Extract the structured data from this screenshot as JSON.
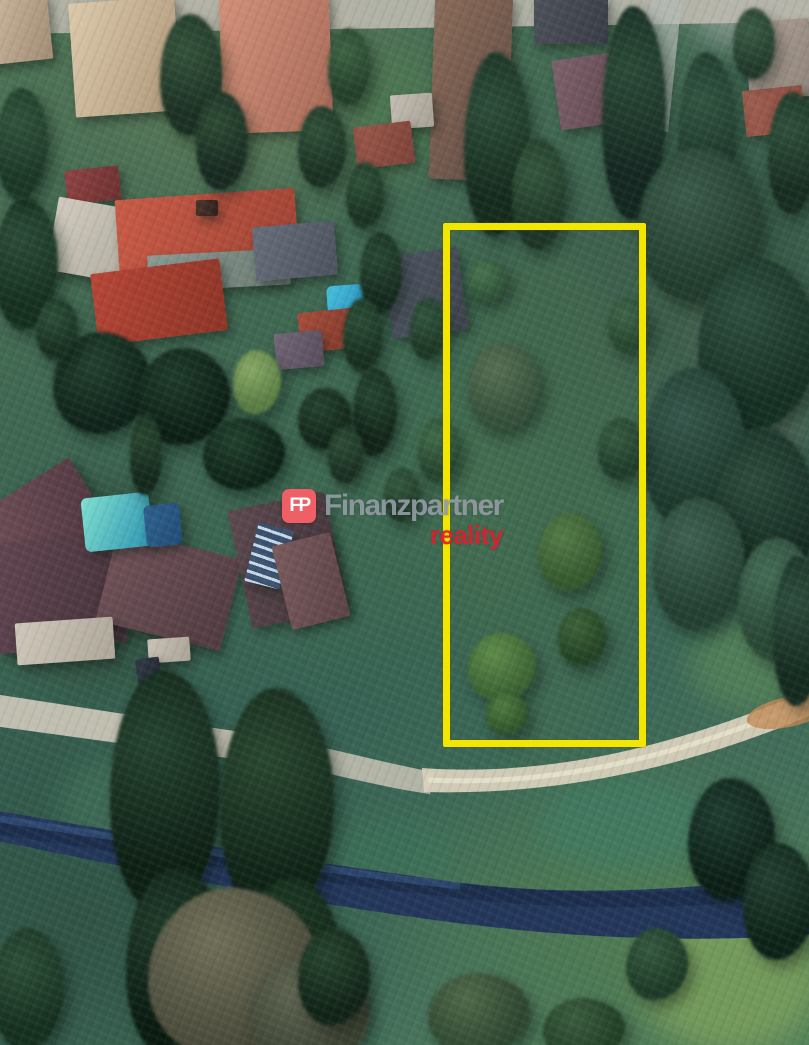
{
  "scene": {
    "type": "aerial-3d-photo",
    "description": "Aerial 3D view of a village land plot highlighted with a yellow boundary, houses with red roofs, gardens, trees, a gravel road and a river"
  },
  "watermark": {
    "logo_text": "FP",
    "brand": "Finanzpartner",
    "sub_brand": "reality",
    "colors": {
      "logo_bg": "#ee5f66",
      "logo_text": "#ffffff",
      "brand": "rgba(150,157,166,0.9)",
      "sub_brand": "rgba(224,31,46,0.93)"
    }
  },
  "property_outline": {
    "color": "#f3e600",
    "border_px": 7,
    "x": 443,
    "y": 223,
    "width": 203,
    "height": 524
  }
}
